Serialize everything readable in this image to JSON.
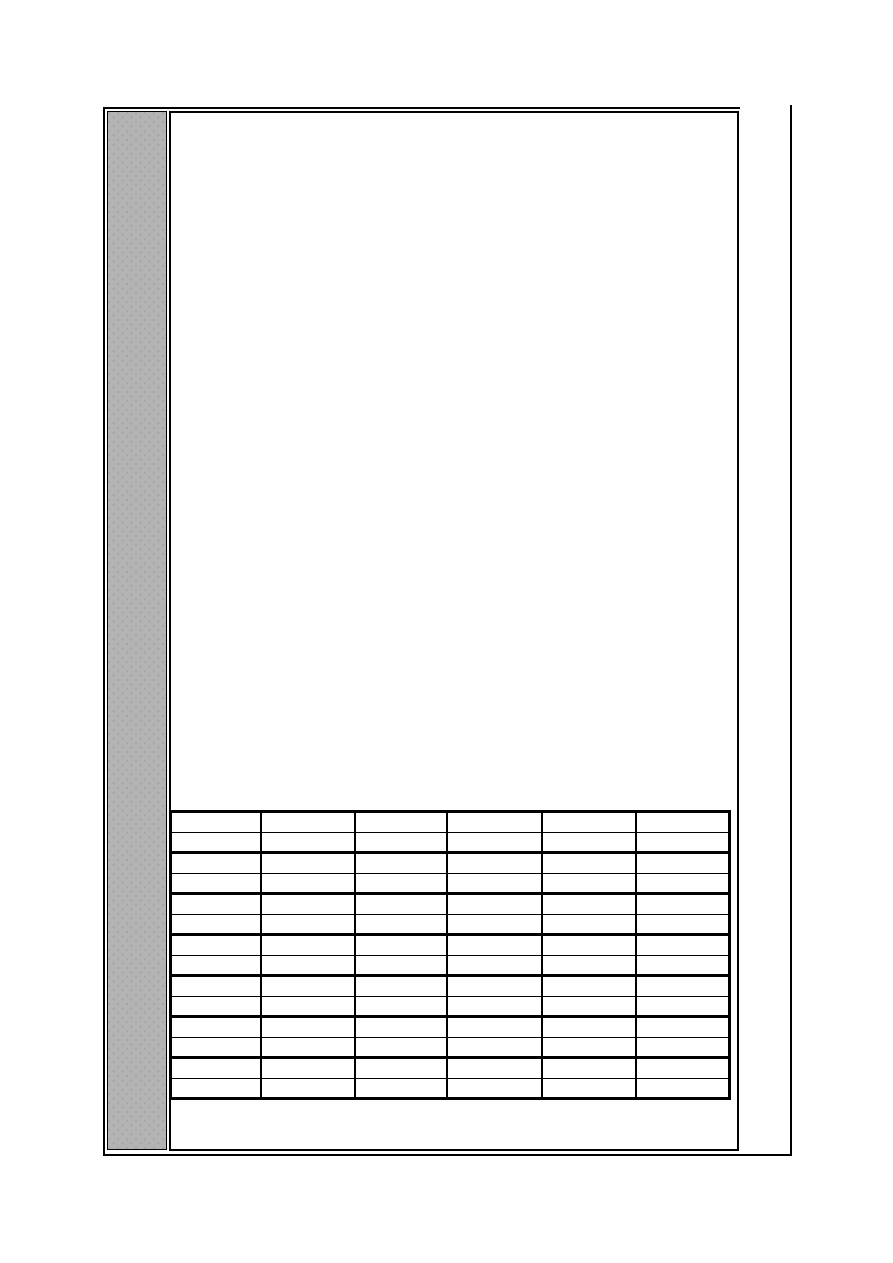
{
  "page": {
    "background": "#ffffff",
    "frame_color": "#000000"
  },
  "sidebar": {
    "fill_color": "#b3b3b3",
    "dot_color": "#9a9a9a",
    "border_color": "#000000"
  },
  "content_panel": {
    "background": "#ffffff",
    "border_color": "#000000",
    "text": ""
  },
  "table": {
    "columns": 6,
    "rows": 14,
    "row_group_size": 2,
    "column_widths_px": [
      90,
      94,
      92,
      95,
      94,
      94
    ],
    "border_color": "#000000",
    "rows_data": [
      [
        "",
        "",
        "",
        "",
        "",
        ""
      ],
      [
        "",
        "",
        "",
        "",
        "",
        ""
      ],
      [
        "",
        "",
        "",
        "",
        "",
        ""
      ],
      [
        "",
        "",
        "",
        "",
        "",
        ""
      ],
      [
        "",
        "",
        "",
        "",
        "",
        ""
      ],
      [
        "",
        "",
        "",
        "",
        "",
        ""
      ],
      [
        "",
        "",
        "",
        "",
        "",
        ""
      ],
      [
        "",
        "",
        "",
        "",
        "",
        ""
      ],
      [
        "",
        "",
        "",
        "",
        "",
        ""
      ],
      [
        "",
        "",
        "",
        "",
        "",
        ""
      ],
      [
        "",
        "",
        "",
        "",
        "",
        ""
      ],
      [
        "",
        "",
        "",
        "",
        "",
        ""
      ],
      [
        "",
        "",
        "",
        "",
        "",
        ""
      ],
      [
        "",
        "",
        "",
        "",
        "",
        ""
      ]
    ]
  }
}
